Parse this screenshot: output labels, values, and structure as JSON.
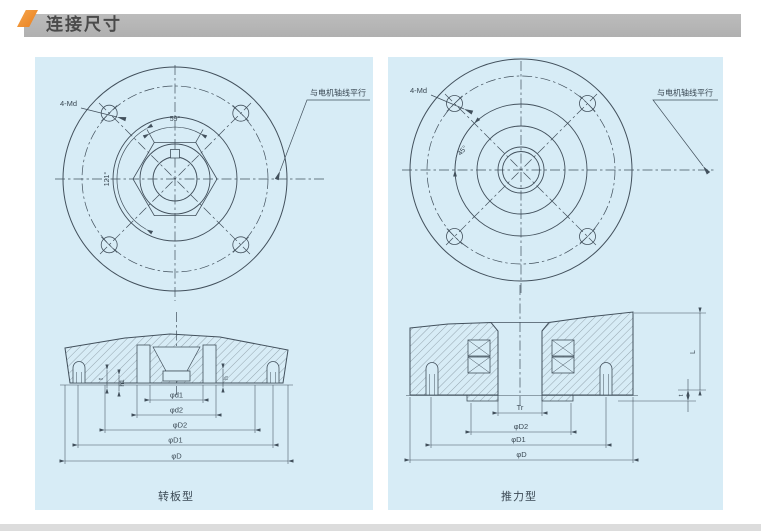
{
  "header": {
    "title": "连接尺寸"
  },
  "colors": {
    "accent_orange": "#ee8a2e",
    "header_bar_gray": "#b5b5b5",
    "panel_background": "#d7ecf6",
    "drawing_line": "#42505c",
    "bottom_bar_gray": "#dcdcdc"
  },
  "left_panel": {
    "caption": "转板型",
    "front": {
      "bolt_label": "4-Md",
      "angle_top": "59°",
      "angle_side": "121°",
      "note": "与电机轴线平行"
    },
    "section": {
      "dims": [
        "φd1",
        "φd2",
        "φD2",
        "φD1",
        "φD"
      ],
      "small_dims": [
        "t",
        "h1",
        "h"
      ]
    }
  },
  "right_panel": {
    "caption": "推力型",
    "front": {
      "bolt_label": "4-Md",
      "angle_top": "45°",
      "note": "与电机轴线平行"
    },
    "section": {
      "dims": [
        "Tr",
        "φD2",
        "φD1",
        "φD"
      ],
      "small_dims": [
        "L",
        "t"
      ]
    }
  }
}
